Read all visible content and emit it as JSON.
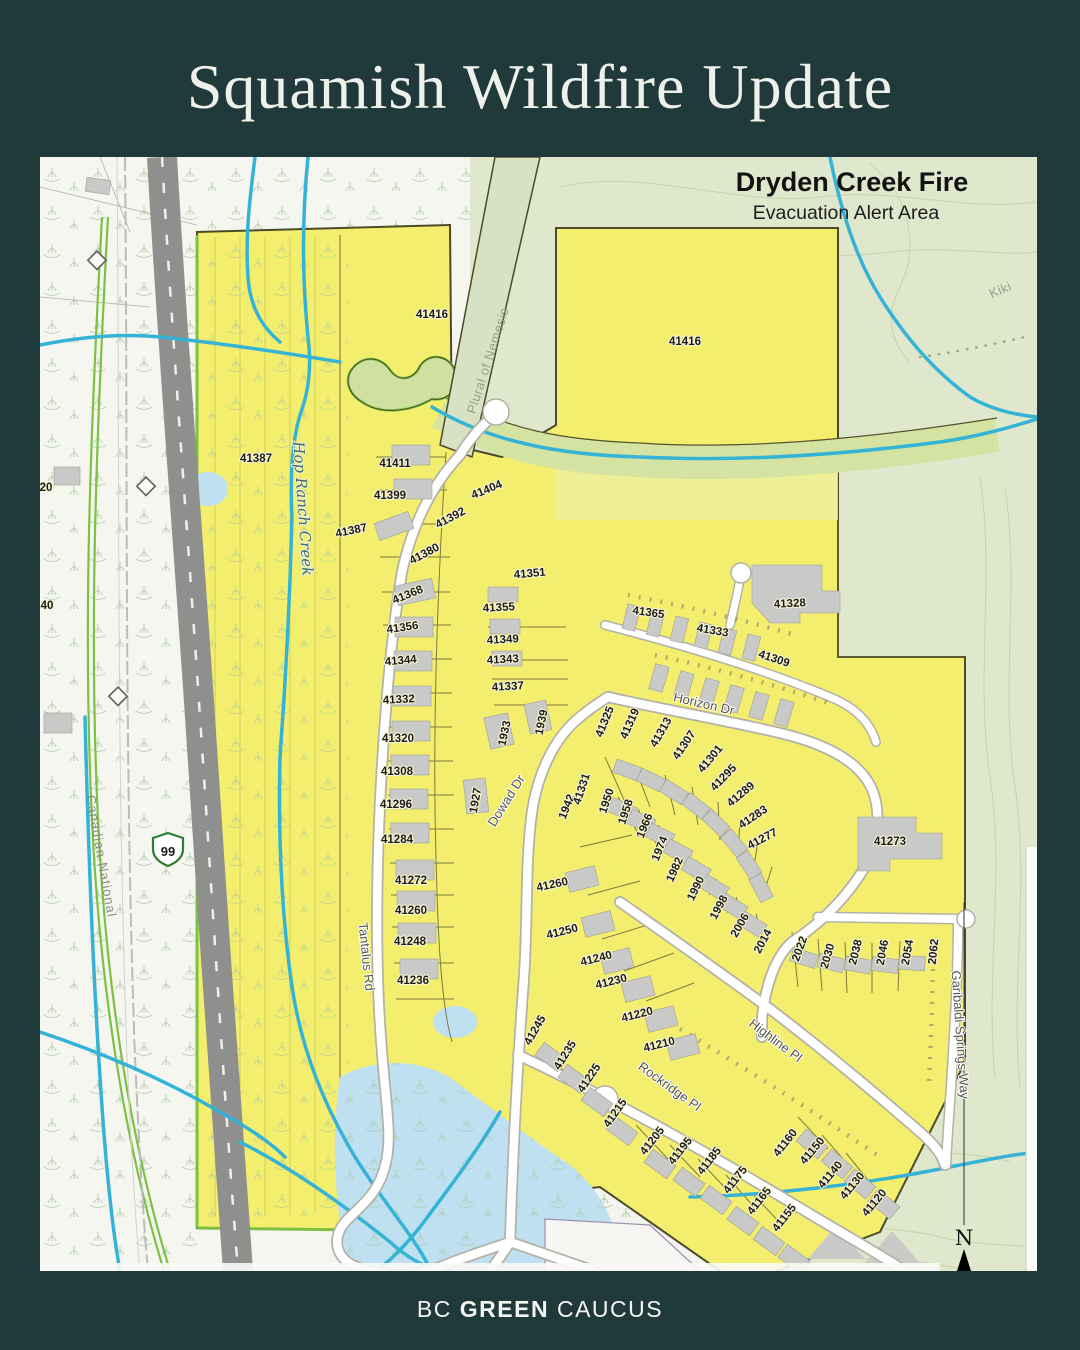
{
  "page": {
    "title": "Squamish Wildfire Update",
    "footer": {
      "prefix": "BC",
      "bold": "GREEN",
      "suffix": "CAUCUS"
    }
  },
  "map": {
    "title": "Dryden Creek Fire",
    "subtitle": "Evacuation Alert Area",
    "north_label": "N",
    "highway_shield": "99",
    "streets": [
      {
        "label": "Tantalus Rd",
        "x": 322,
        "y": 800,
        "rot": 84
      },
      {
        "label": "Dowad Dr",
        "x": 470,
        "y": 646,
        "rot": -58
      },
      {
        "label": "Horizon Dr",
        "x": 663,
        "y": 551,
        "rot": 13,
        "size": 14
      },
      {
        "label": "Rockridge Pl",
        "x": 627,
        "y": 933,
        "rot": 36
      },
      {
        "label": "Highline Pl",
        "x": 733,
        "y": 887,
        "rot": 37
      },
      {
        "label": "Garibaldi Springs Way",
        "x": 916,
        "y": 878,
        "rot": 86,
        "size": 12
      },
      {
        "label": "Canadian National",
        "x": 57,
        "y": 700,
        "rot": 80,
        "cls": "rail",
        "size": 11
      }
    ],
    "waterways": [
      {
        "label": "Hop Ranch Creek",
        "x": 258,
        "y": 352,
        "rot": 86
      }
    ],
    "trails": [
      {
        "label": "Plural of Nemesis",
        "x": 452,
        "y": 205,
        "rot": -72
      },
      {
        "label": "Kiki",
        "x": 962,
        "y": 137,
        "rot": -22,
        "size": 12
      }
    ],
    "edge_labels": [
      {
        "label": "20",
        "x": 6,
        "y": 334
      },
      {
        "label": "40",
        "x": 7,
        "y": 452
      }
    ],
    "parcels": [
      {
        "label": "41416",
        "x": 392,
        "y": 161,
        "size": 13
      },
      {
        "label": "41416",
        "x": 645,
        "y": 188,
        "size": 13
      },
      {
        "label": "41387",
        "x": 216,
        "y": 305,
        "size": 13
      },
      {
        "label": "41411",
        "x": 355,
        "y": 310
      },
      {
        "label": "41399",
        "x": 350,
        "y": 342
      },
      {
        "label": "41387",
        "x": 312,
        "y": 377,
        "rot": -12
      },
      {
        "label": "41404",
        "x": 448,
        "y": 336,
        "rot": -22
      },
      {
        "label": "41392",
        "x": 412,
        "y": 364,
        "rot": -28
      },
      {
        "label": "41380",
        "x": 386,
        "y": 400,
        "rot": -28
      },
      {
        "label": "41368",
        "x": 369,
        "y": 441,
        "rot": -22
      },
      {
        "label": "41356",
        "x": 363,
        "y": 474,
        "rot": -8
      },
      {
        "label": "41344",
        "x": 361,
        "y": 507,
        "rot": -5
      },
      {
        "label": "41332",
        "x": 359,
        "y": 546,
        "rot": -3
      },
      {
        "label": "41320",
        "x": 358,
        "y": 585
      },
      {
        "label": "41308",
        "x": 357,
        "y": 618
      },
      {
        "label": "41296",
        "x": 356,
        "y": 651
      },
      {
        "label": "41284",
        "x": 357,
        "y": 686
      },
      {
        "label": "41272",
        "x": 371,
        "y": 727
      },
      {
        "label": "41260",
        "x": 371,
        "y": 757
      },
      {
        "label": "41248",
        "x": 370,
        "y": 788
      },
      {
        "label": "41236",
        "x": 373,
        "y": 827
      },
      {
        "label": "41351",
        "x": 490,
        "y": 420,
        "rot": -5
      },
      {
        "label": "41355",
        "x": 459,
        "y": 454,
        "rot": -3
      },
      {
        "label": "41349",
        "x": 463,
        "y": 486,
        "rot": -3
      },
      {
        "label": "41343",
        "x": 463,
        "y": 506,
        "rot": -3
      },
      {
        "label": "41337",
        "x": 468,
        "y": 533,
        "rot": -3
      },
      {
        "label": "1933",
        "x": 468,
        "y": 577,
        "rot": -78
      },
      {
        "label": "1939",
        "x": 505,
        "y": 566,
        "rot": -78
      },
      {
        "label": "1927",
        "x": 439,
        "y": 644,
        "rot": -80
      },
      {
        "label": "1942",
        "x": 530,
        "y": 651,
        "rot": -68
      },
      {
        "label": "41331",
        "x": 545,
        "y": 633,
        "rot": -72
      },
      {
        "label": "41325",
        "x": 568,
        "y": 566,
        "rot": -68
      },
      {
        "label": "41319",
        "x": 593,
        "y": 568,
        "rot": -66
      },
      {
        "label": "41313",
        "x": 624,
        "y": 577,
        "rot": -60
      },
      {
        "label": "41307",
        "x": 647,
        "y": 590,
        "rot": -56
      },
      {
        "label": "41301",
        "x": 673,
        "y": 604,
        "rot": -50
      },
      {
        "label": "41295",
        "x": 686,
        "y": 623,
        "rot": -46
      },
      {
        "label": "41289",
        "x": 703,
        "y": 640,
        "rot": -40
      },
      {
        "label": "41283",
        "x": 715,
        "y": 663,
        "rot": -34
      },
      {
        "label": "41277",
        "x": 724,
        "y": 685,
        "rot": -28
      },
      {
        "label": "1950",
        "x": 570,
        "y": 645,
        "rot": -72
      },
      {
        "label": "1958",
        "x": 589,
        "y": 656,
        "rot": -72
      },
      {
        "label": "1966",
        "x": 608,
        "y": 670,
        "rot": -68
      },
      {
        "label": "1974",
        "x": 623,
        "y": 693,
        "rot": -68
      },
      {
        "label": "1982",
        "x": 638,
        "y": 714,
        "rot": -66
      },
      {
        "label": "1990",
        "x": 659,
        "y": 733,
        "rot": -64
      },
      {
        "label": "1998",
        "x": 682,
        "y": 752,
        "rot": -62
      },
      {
        "label": "2006",
        "x": 703,
        "y": 770,
        "rot": -60
      },
      {
        "label": "2014",
        "x": 726,
        "y": 786,
        "rot": -62
      },
      {
        "label": "2022",
        "x": 763,
        "y": 793,
        "rot": -70
      },
      {
        "label": "2030",
        "x": 791,
        "y": 800,
        "rot": -74
      },
      {
        "label": "2038",
        "x": 819,
        "y": 796,
        "rot": -76
      },
      {
        "label": "2046",
        "x": 846,
        "y": 796,
        "rot": -80
      },
      {
        "label": "2054",
        "x": 871,
        "y": 796,
        "rot": -80
      },
      {
        "label": "2062",
        "x": 897,
        "y": 795,
        "rot": -84
      },
      {
        "label": "41365",
        "x": 608,
        "y": 459,
        "rot": 8
      },
      {
        "label": "41333",
        "x": 672,
        "y": 477,
        "rot": 10
      },
      {
        "label": "41309",
        "x": 733,
        "y": 505,
        "rot": 18
      },
      {
        "label": "41328",
        "x": 750,
        "y": 450,
        "rot": -3,
        "size": 11
      },
      {
        "label": "41273",
        "x": 850,
        "y": 688,
        "size": 13
      },
      {
        "label": "41260",
        "x": 513,
        "y": 731,
        "rot": -12
      },
      {
        "label": "41250",
        "x": 523,
        "y": 778,
        "rot": -14
      },
      {
        "label": "41240",
        "x": 557,
        "y": 805,
        "rot": -14
      },
      {
        "label": "41230",
        "x": 572,
        "y": 828,
        "rot": -14
      },
      {
        "label": "41220",
        "x": 598,
        "y": 861,
        "rot": -14
      },
      {
        "label": "41210",
        "x": 620,
        "y": 891,
        "rot": -14
      },
      {
        "label": "41245",
        "x": 498,
        "y": 875,
        "rot": -60
      },
      {
        "label": "41235",
        "x": 528,
        "y": 900,
        "rot": -58
      },
      {
        "label": "41225",
        "x": 552,
        "y": 923,
        "rot": -56
      },
      {
        "label": "41215",
        "x": 578,
        "y": 958,
        "rot": -55
      },
      {
        "label": "41205",
        "x": 615,
        "y": 986,
        "rot": -52
      },
      {
        "label": "41195",
        "x": 643,
        "y": 996,
        "rot": -52
      },
      {
        "label": "41185",
        "x": 672,
        "y": 1006,
        "rot": -52
      },
      {
        "label": "41175",
        "x": 698,
        "y": 1025,
        "rot": -52
      },
      {
        "label": "41165",
        "x": 722,
        "y": 1046,
        "rot": -52
      },
      {
        "label": "41155",
        "x": 747,
        "y": 1063,
        "rot": -52
      },
      {
        "label": "41160",
        "x": 748,
        "y": 988,
        "rot": -52
      },
      {
        "label": "41150",
        "x": 775,
        "y": 996,
        "rot": -50
      },
      {
        "label": "41140",
        "x": 793,
        "y": 1020,
        "rot": -50
      },
      {
        "label": "41130",
        "x": 815,
        "y": 1031,
        "rot": -50
      },
      {
        "label": "41120",
        "x": 837,
        "y": 1048,
        "rot": -50
      }
    ]
  },
  "colors": {
    "background": "#20393b",
    "evacuation_yellow": "#f4ee6e",
    "topo_green": "#dfe7cd",
    "water_blue": "#35b3d6",
    "road_gray": "#8f8f8d",
    "boundary_lime": "#7cc144",
    "building_gray": "#c9c9c7"
  }
}
